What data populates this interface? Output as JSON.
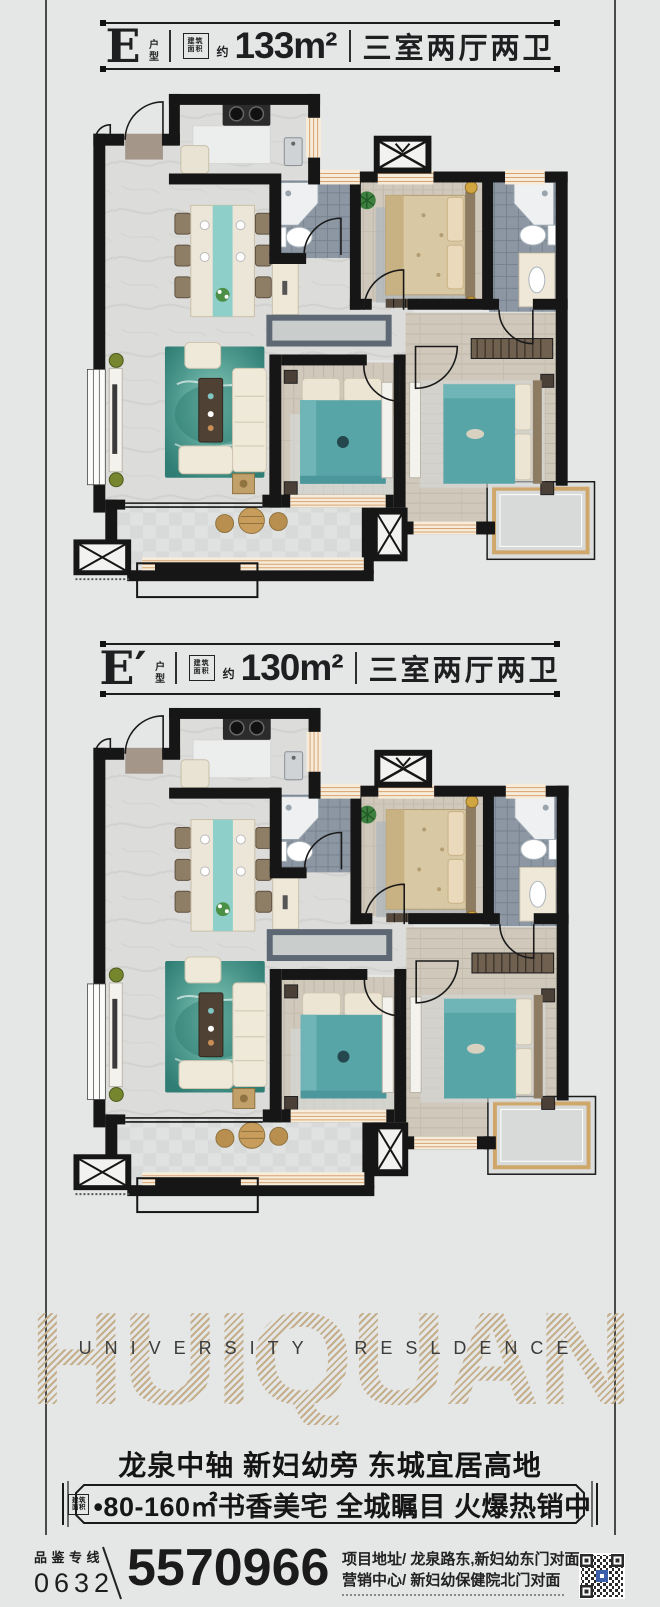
{
  "plans": [
    {
      "letter": "E",
      "suffix": "户型",
      "area_box_line1": "建筑",
      "area_box_line2": "面积",
      "approx": "约",
      "area": "133m²",
      "rooms": "三室两厅两卫"
    },
    {
      "letter": "E′",
      "suffix": "户型",
      "area_box_line1": "建筑",
      "area_box_line2": "面积",
      "approx": "约",
      "area": "130m²",
      "rooms": "三室两厅两卫"
    }
  ],
  "branding": {
    "watermark": "HUIQUAN",
    "english_line": "UNIVERSITY RESLDENCE"
  },
  "marketing": {
    "headline": "龙泉中轴 新妇幼旁 东城宜居高地",
    "banner_box_line1": "建筑",
    "banner_box_line2": "面积",
    "banner_text": "•80-160㎡书香美宅 全城瞩目 火爆热销中"
  },
  "footer": {
    "hotline_label": "品鉴专线",
    "area_code": "0632",
    "phone": "5570966",
    "address_line1": "项目地址/ 龙泉路东,新妇幼东门对面",
    "address_line2": "营销中心/ 新妇幼保健院北门对面"
  },
  "colors": {
    "background": "#e5e7e6",
    "wall": "#161616",
    "accent_teal": "#58a5a8",
    "bed_tan": "#d8c8a4",
    "watermark_tan": "#c9b493",
    "tile_gray": "#8d97a3",
    "window_wood": "#d8a271",
    "qr_blue": "#3b5fa8"
  }
}
